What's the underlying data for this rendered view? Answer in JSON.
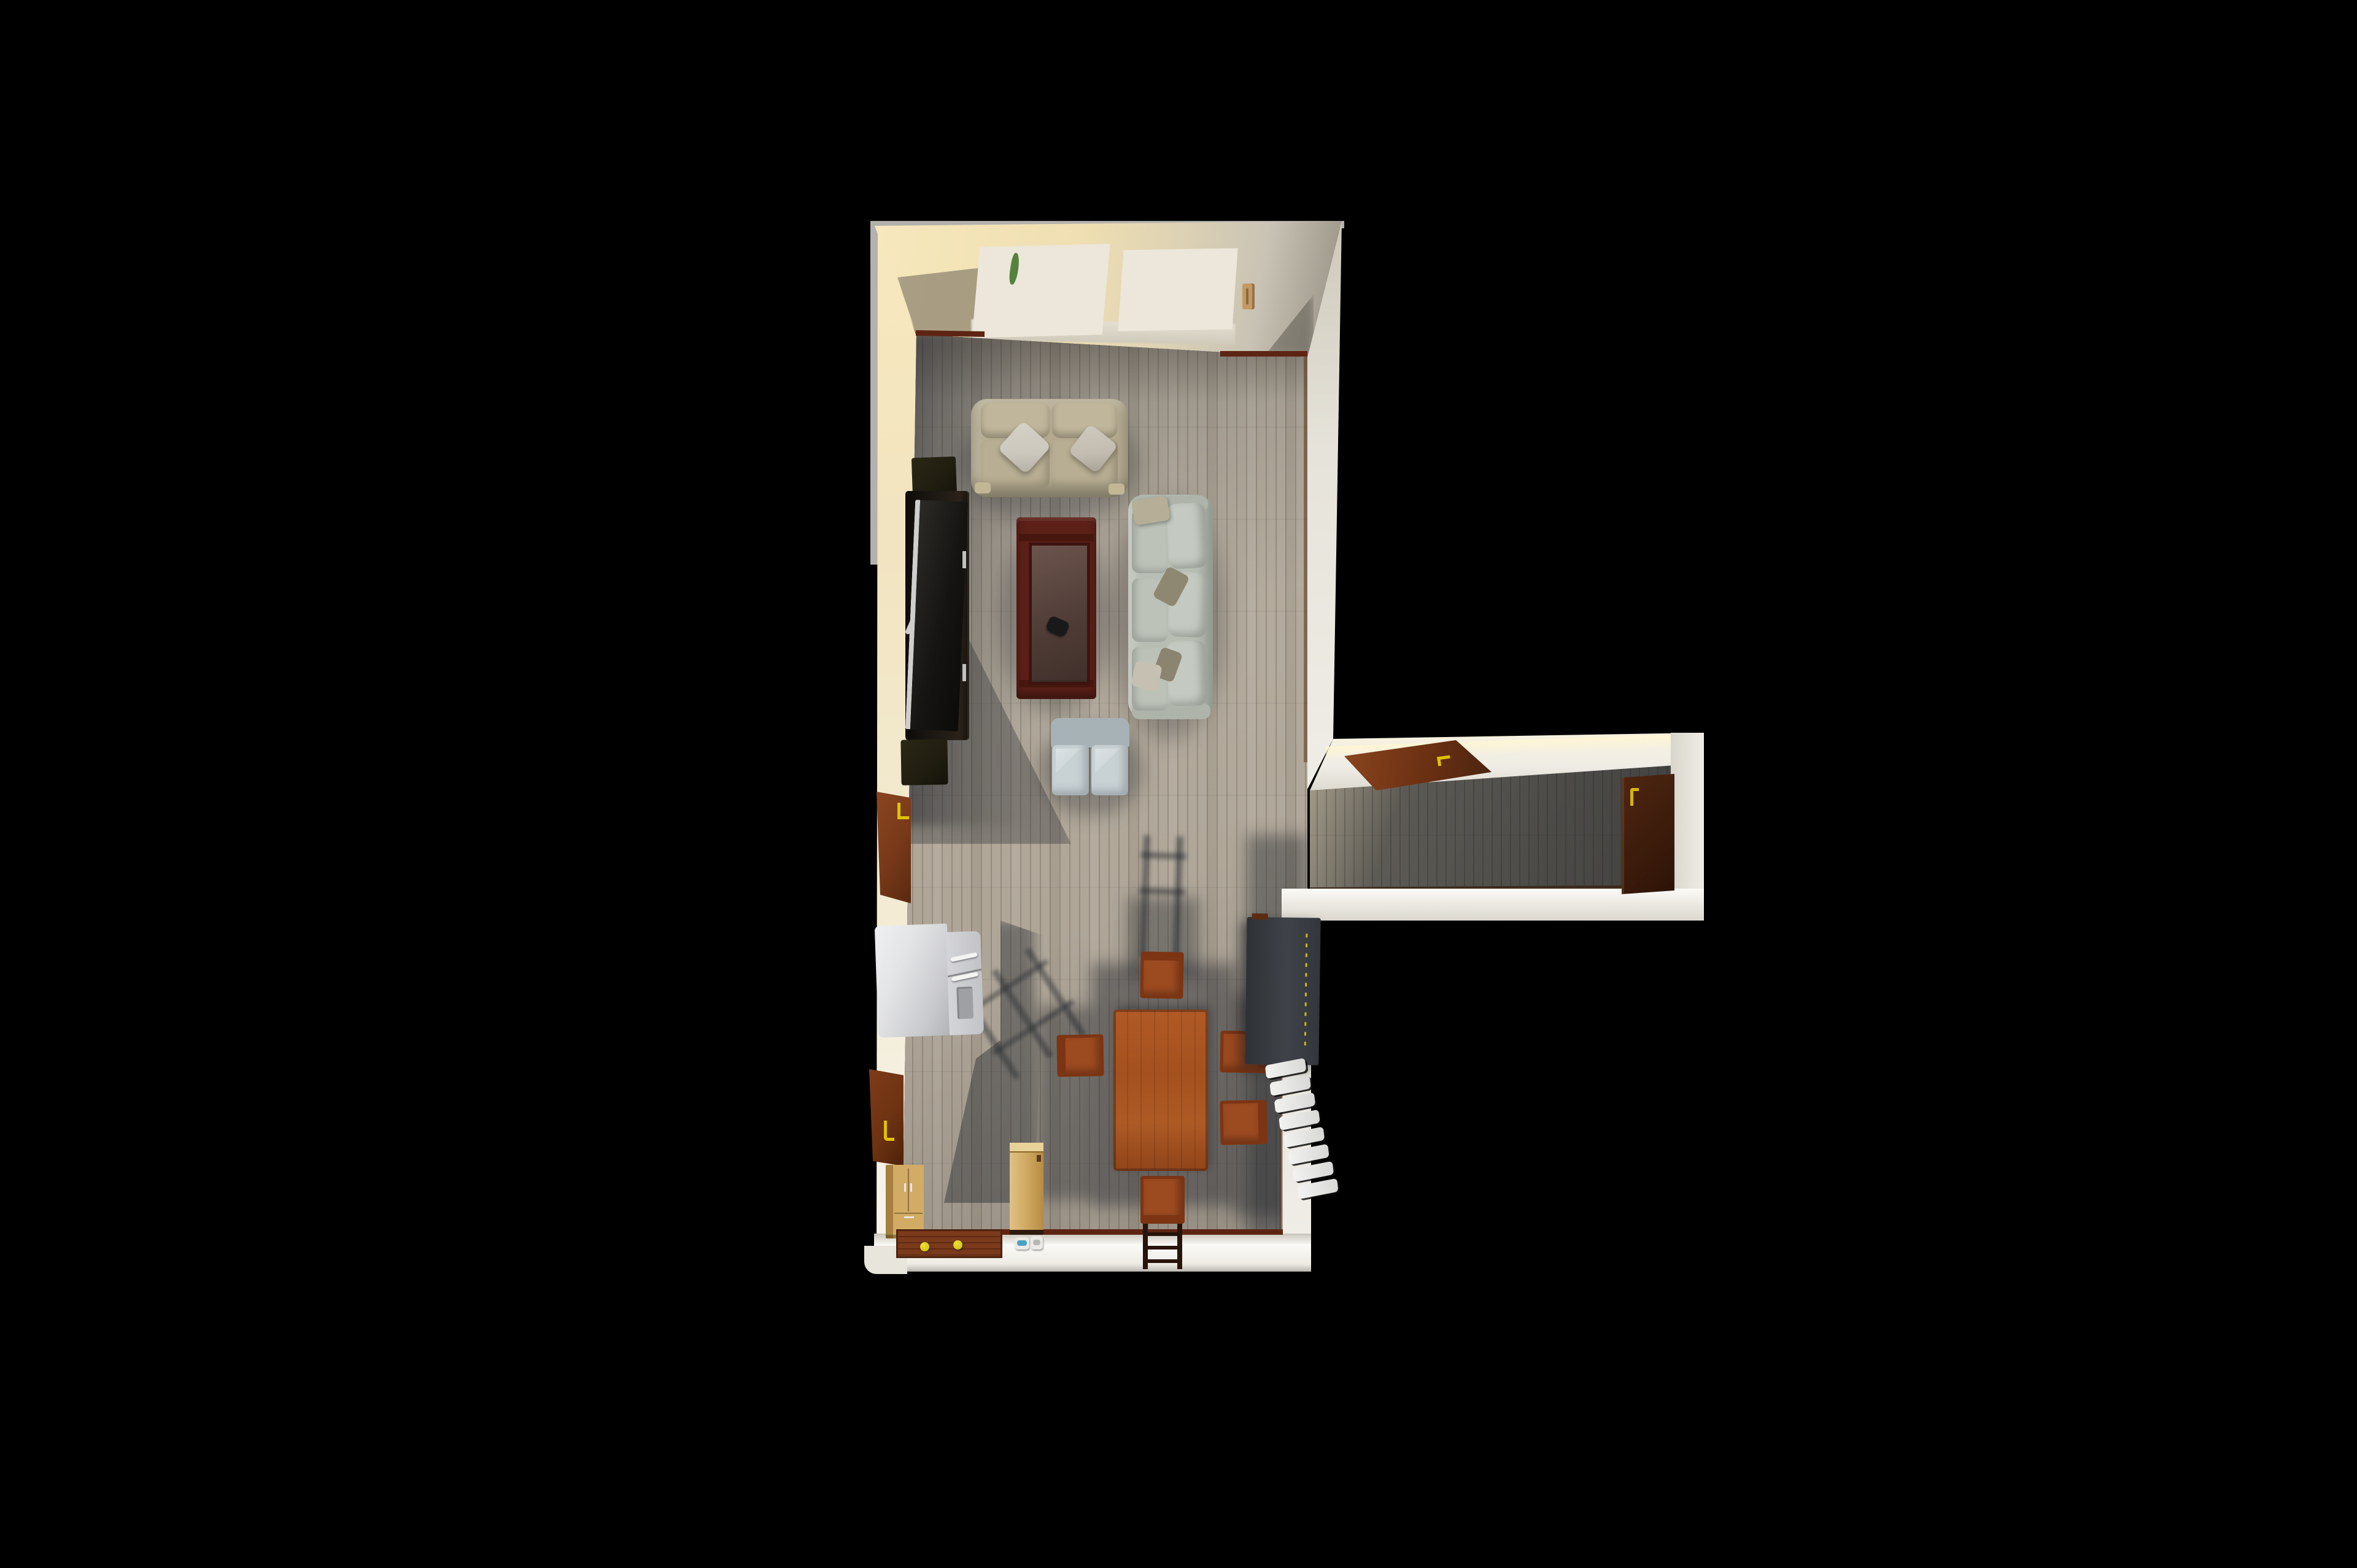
{
  "scene": {
    "type": "3d-floorplan-render",
    "description": "Aerial 3D rendering of an L-shaped apartment on a black background: an open living and dining room at left with a shadowed hallway extending to the right",
    "background_color": "#000000",
    "rooms": [
      {
        "id": "living-dining-room",
        "floor_material": "light oak plank flooring",
        "wall_color_hint": "warm cream and white"
      },
      {
        "id": "hallway",
        "floor_material": "oak plank flooring in shadow",
        "wall_color_hint": "white"
      }
    ]
  },
  "palette": {
    "bg": "#000000",
    "outer_rim": "#b3b1ad",
    "wall_cream_bright": "#f7e8bd",
    "wall_cream": "#efdfb2",
    "wall_gray": "#c9c3b5",
    "wall_gray_dark": "#918b7f",
    "wall_white": "#efede6",
    "wall_white_bright": "#fbfaf6",
    "floor_light": "#b6aea0",
    "floor_base": "#aba294",
    "floor_hall": "#97907e",
    "baseboard": "#5e2413",
    "window_frame": "#ece7da",
    "window_pane": "#3a4246",
    "plant_green": "#55823c",
    "handle_tan": "#c49a62",
    "sofa_love": "#b2a98e",
    "sofa_love_cushion": "#bfb69b",
    "pillow_light": "#cdc8be",
    "sofa_main": "#b7bdb3",
    "sofa_main_cushion": "#c4cac1",
    "pillow_olive": "#8e8872",
    "pillow_tan": "#b6ae97",
    "ottoman_back": "#a7b2b6",
    "ottoman_seat": "#c8d1d4",
    "table_frame": "#5c2018",
    "controller": "#191919",
    "tv_dark": "#17120d",
    "tv_silver": "#cfcfcd",
    "speaker": "#201d10",
    "door_brown": "#7a3a1a",
    "handle_yellow": "#e0c200",
    "fridge_light": "#e3e4e6",
    "fridge_mid": "#c9cacd",
    "fridge_dark": "#b2b3b6",
    "cabinet_brown": "#6e3312",
    "wood_light": "#d2ab64",
    "wood_light_dark": "#a5803f",
    "mat_brown": "#6b3118",
    "ball_yellow": "#d8c90f",
    "bowl_white": "#eceae6",
    "bowl_blue": "#4aa3c4",
    "dining_wood": "#a4511f",
    "dining_wood_dark": "#7c3413",
    "chair_wood": "#9c4a20",
    "sideboard_dark": "#33363b",
    "sideboard_light": "#3f4349",
    "stitch_yellow": "#c9b912",
    "radiator_white": "#f2f2f0"
  },
  "structure": {
    "windows": [
      {
        "id": "window-left",
        "pane_columns": 3,
        "pane_rows": 5,
        "frame": "white",
        "note": "green plant leaf visible in upper-left pane"
      },
      {
        "id": "window-right",
        "pane_columns": 3,
        "pane_rows": 5,
        "frame": "white",
        "note": "tan handle on wall to its right"
      }
    ],
    "doors": [
      {
        "id": "living-room-left-door",
        "color": "brown",
        "handle": "yellow"
      },
      {
        "id": "left-wall-cabinet-door",
        "color": "brown",
        "handle": "yellow J-shaped"
      },
      {
        "id": "hallway-top-door",
        "color": "brown",
        "handle": "yellow"
      },
      {
        "id": "hallway-end-door",
        "color": "dark brown (in shadow)",
        "handle": "yellow"
      }
    ]
  },
  "furniture": [
    {
      "id": "loveseat",
      "label": "Two-seat cream loveseat with two light diamond pillows"
    },
    {
      "id": "sofa",
      "label": "Three-seat pale gray-green sofa with olive and tan accent pillows"
    },
    {
      "id": "ottoman",
      "label": "Two-cushion blue-gray ottoman bench"
    },
    {
      "id": "coffee-table",
      "label": "Mahogany coffee table with glass top"
    },
    {
      "id": "game-controller",
      "label": "Black game controller on the coffee table"
    },
    {
      "id": "tv-stand",
      "label": "Dark wood TV console"
    },
    {
      "id": "tv",
      "label": "Flat-screen TV with silver frame and X-shaped legs"
    },
    {
      "id": "speakers",
      "label": "Two dark speaker cabinets flanking the TV",
      "count": 2
    },
    {
      "id": "fridge",
      "label": "Silver-white refrigerator with two handles and dispenser"
    },
    {
      "id": "dining-table",
      "label": "Rectangular red-brown wood dining table"
    },
    {
      "id": "dining-chairs",
      "label": "Red-brown wood dining chairs (top, left, two right, bottom with ladder back)",
      "count": 5
    },
    {
      "id": "sideboard",
      "label": "Tall dark gray cabinet with yellow stitch line against right wall"
    },
    {
      "id": "radiator",
      "label": "White sectional radiator with 8 segments"
    },
    {
      "id": "small-cabinet",
      "label": "Light wood cabinet with steel handles"
    },
    {
      "id": "tall-cabinet",
      "label": "Tall light wood cabinet near bottom wall"
    },
    {
      "id": "door-mat",
      "label": "Red-brown wooden door mat"
    },
    {
      "id": "toy-balls",
      "label": "Two yellow balls on the mat",
      "count": 2
    },
    {
      "id": "pet-bowls",
      "label": "White pet bowls, one with blue water"
    }
  ]
}
